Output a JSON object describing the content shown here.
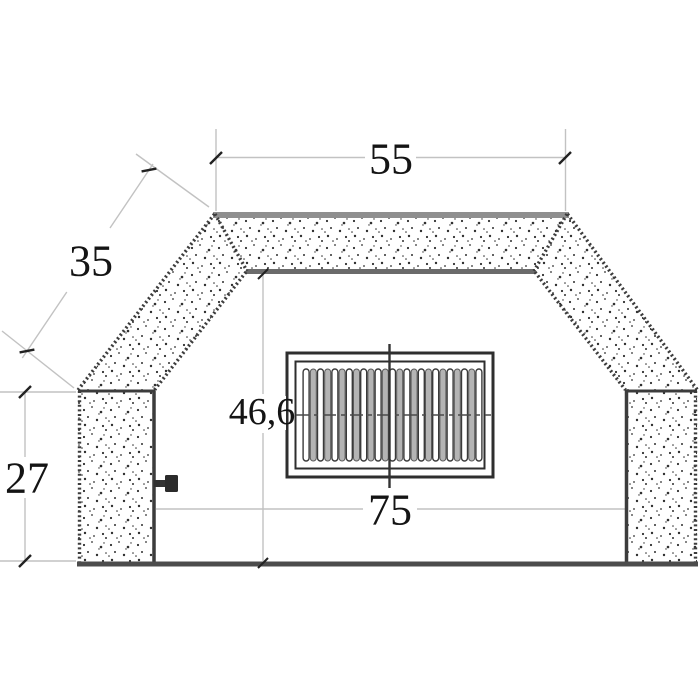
{
  "drawing": {
    "type": "technical-dimension-drawing",
    "labels": {
      "top_width": "55",
      "slope_length": "35",
      "pillar_height": "27",
      "opening_height": "46,6",
      "opening_width": "75"
    },
    "grille": {
      "white_slats": 13,
      "gray_slats": 12
    },
    "colors": {
      "background": "#ffffff",
      "stipple_dot": "#2f2f2f",
      "edge_dark": "#3c3c3c",
      "beam_top_edge": "#8f8f8f",
      "beam_bottom_edge": "#6b6b6b",
      "floor": "#4c4c4c",
      "dim_line": "#c2c2c2",
      "tick": "#222222",
      "grille_line": "#2e2e2e",
      "slat_gray": "#b4b4b4",
      "centerline": "#333333",
      "text": "#141414",
      "knob": "#2b2b2b"
    }
  }
}
